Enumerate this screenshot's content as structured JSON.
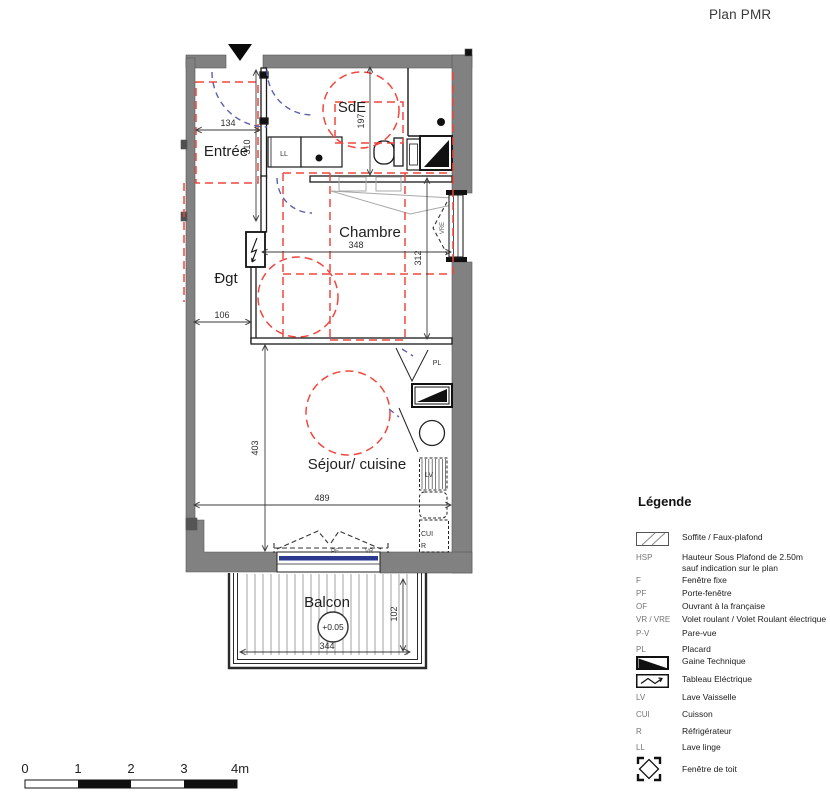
{
  "title": "Plan PMR",
  "plan": {
    "rooms": {
      "entree": {
        "label": "Entrée"
      },
      "sde": {
        "label": "SdE"
      },
      "chambre": {
        "label": "Chambre"
      },
      "dgt": {
        "label": "Ðgt"
      },
      "sejour": {
        "label": "Séjour/ cuisine"
      },
      "balcon": {
        "label": "Balcon"
      }
    },
    "dims": {
      "entree_width": "134",
      "entree_depth": "310",
      "sde_depth": "197",
      "chambre_width": "348",
      "chambre_depth": "312",
      "dgt_width": "106",
      "sejour_depth": "403",
      "sejour_width": "489",
      "balcon_width": "344",
      "balcon_depth": "102"
    },
    "annotations": {
      "level": "+0.05",
      "washing_machine": "LL",
      "closet": "PL",
      "dishwasher": "LV",
      "cooktop": "CUI",
      "fridge": "R",
      "balcony_door": "PF",
      "shutter": "VR",
      "window_shutter": "VRE"
    }
  },
  "legend": {
    "title": "Légende",
    "items": [
      {
        "code": "",
        "label": "Soffite / Faux-plafond"
      },
      {
        "code": "HSP",
        "label": "Hauteur Sous Plafond de 2.50m",
        "label2": "sauf indication sur le plan"
      },
      {
        "code": "F",
        "label": "Fenêtre fixe"
      },
      {
        "code": "PF",
        "label": "Porte-fenêtre"
      },
      {
        "code": "OF",
        "label": "Ouvrant à la française"
      },
      {
        "code": "VR / VRE",
        "label": "Volet roulant / Volet Roulant électrique"
      },
      {
        "code": "P-V",
        "label": "Pare-vue"
      },
      {
        "code": "PL",
        "label": "Placard"
      },
      {
        "code": "",
        "label": "Gaine Technique"
      },
      {
        "code": "",
        "label": "Tableau Eléctrique"
      },
      {
        "code": "LV",
        "label": "Lave Vaisselle"
      },
      {
        "code": "CUI",
        "label": "Cuisson"
      },
      {
        "code": "R",
        "label": "Réfrigérateur"
      },
      {
        "code": "LL",
        "label": "Lave linge"
      },
      {
        "code": "",
        "label": "Fenêtre de toit"
      }
    ]
  },
  "scalebar": {
    "t0": "0",
    "t1": "1",
    "t2": "2",
    "t3": "3",
    "t4": "4m"
  },
  "colors": {
    "wall": "#818181",
    "pmr": "#f2463d",
    "swing": "#5a5fae",
    "glazing": "#2b3a8f"
  }
}
